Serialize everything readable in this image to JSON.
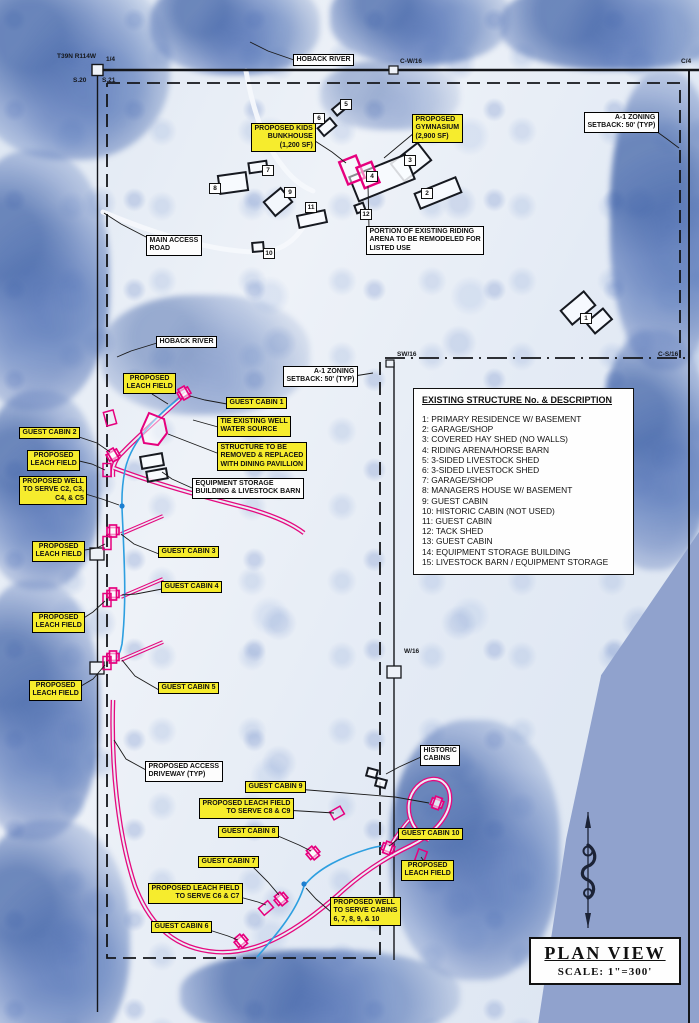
{
  "title_box": {
    "title": "PLAN VIEW",
    "scale": "SCALE:  1\"=300'"
  },
  "legend": {
    "title": "EXISTING STRUCTURE No. & DESCRIPTION",
    "items": [
      "1: PRIMARY RESIDENCE W/ BASEMENT",
      "2: GARAGE/SHOP",
      "3: COVERED HAY SHED (NO WALLS)",
      "4: RIDING ARENA/HORSE BARN",
      "5: 3-SIDED LIVESTOCK SHED",
      "6: 3-SIDED LIVESTOCK SHED",
      "7: GARAGE/SHOP",
      "8: MANAGERS HOUSE W/ BASEMENT",
      "9: GUEST CABIN",
      "10: HISTORIC CABIN (NOT USED)",
      "11: GUEST CABIN",
      "12: TACK SHED",
      "13: GUEST CABIN",
      "14: EQUIPMENT STORAGE BUILDING",
      "15: LIVESTOCK BARN / EQUIPMENT STORAGE"
    ]
  },
  "corner_texts": [
    {
      "text": "T39N  R114W",
      "x": 57,
      "y": 53
    },
    {
      "text": "1/4",
      "x": 106,
      "y": 56
    },
    {
      "text": "S.20",
      "x": 73,
      "y": 77
    },
    {
      "text": "S.21",
      "x": 102,
      "y": 77
    },
    {
      "text": "C-W/16",
      "x": 400,
      "y": 58
    },
    {
      "text": "C/4",
      "x": 681,
      "y": 58
    },
    {
      "text": "SW/16",
      "x": 397,
      "y": 351
    },
    {
      "text": "C-S/16",
      "x": 658,
      "y": 351
    },
    {
      "text": "W/16",
      "x": 404,
      "y": 648
    }
  ],
  "labels": [
    {
      "id": "label-hoback-river-top",
      "text": "HOBACK RIVER",
      "style": "white",
      "x": 293,
      "y": 54
    },
    {
      "id": "label-proposed-kids-bunkhouse",
      "text": "PROPOSED KIDS\nBUNKHOUSE\n(1,200 SF)",
      "style": "yellow",
      "x": 251,
      "y": 123,
      "align": "right"
    },
    {
      "id": "label-proposed-gymnasium",
      "text": "PROPOSED\nGYMNASIUM\n(2,900 SF)",
      "style": "yellow",
      "x": 412,
      "y": 114,
      "align": "left"
    },
    {
      "id": "label-a1-zoning-top",
      "text": "A-1 ZONING\nSETBACK: 50' (TYP)",
      "style": "white",
      "x": 584,
      "y": 112,
      "align": "right"
    },
    {
      "id": "label-main-access-road",
      "text": "MAIN ACCESS\nROAD",
      "style": "white",
      "x": 146,
      "y": 235,
      "align": "left"
    },
    {
      "id": "label-riding-arena-note",
      "text": "PORTION OF EXISTING RIDING\nARENA TO BE REMODELED FOR\nLISTED USE",
      "style": "white",
      "x": 366,
      "y": 226,
      "align": "left"
    },
    {
      "id": "label-hoback-river-mid",
      "text": "HOBACK RIVER",
      "style": "white",
      "x": 156,
      "y": 336
    },
    {
      "id": "label-a1-zoning-mid",
      "text": "A-1 ZONING\nSETBACK: 50' (TYP)",
      "style": "white",
      "x": 283,
      "y": 366,
      "align": "right"
    },
    {
      "id": "label-proposed-leach-field-1",
      "text": "PROPOSED\nLEACH FIELD",
      "style": "yellow",
      "x": 123,
      "y": 373
    },
    {
      "id": "label-guest-cabin-1",
      "text": "GUEST CABIN 1",
      "style": "yellow",
      "x": 226,
      "y": 397
    },
    {
      "id": "label-tie-existing-well",
      "text": "TIE EXISTING WELL\nWATER SOURCE",
      "style": "yellow",
      "x": 217,
      "y": 416,
      "align": "left"
    },
    {
      "id": "label-guest-cabin-2",
      "text": "GUEST CABIN 2",
      "style": "yellow",
      "x": 19,
      "y": 427
    },
    {
      "id": "label-structure-to-be-removed",
      "text": "STRUCTURE TO BE\nREMOVED & REPLACED\nWITH DINING PAVILLION",
      "style": "yellow",
      "x": 217,
      "y": 442,
      "align": "left"
    },
    {
      "id": "label-proposed-leach-field-2",
      "text": "PROPOSED\nLEACH FIELD",
      "style": "yellow",
      "x": 27,
      "y": 450
    },
    {
      "id": "label-proposed-well-c2-c5",
      "text": "PROPOSED WELL\nTO SERVE C2, C3,\nC4, & C5",
      "style": "yellow",
      "x": 19,
      "y": 476,
      "align": "right"
    },
    {
      "id": "label-equipment-storage",
      "text": "EQUIPMENT STORAGE\nBUILDING & LIVESTOCK BARN",
      "style": "white",
      "x": 192,
      "y": 478,
      "align": "left"
    },
    {
      "id": "label-proposed-leach-field-3",
      "text": "PROPOSED\nLEACH FIELD",
      "style": "yellow",
      "x": 32,
      "y": 541
    },
    {
      "id": "label-guest-cabin-3",
      "text": "GUEST CABIN 3",
      "style": "yellow",
      "x": 158,
      "y": 546
    },
    {
      "id": "label-guest-cabin-4",
      "text": "GUEST CABIN 4",
      "style": "yellow",
      "x": 161,
      "y": 581
    },
    {
      "id": "label-proposed-leach-field-4",
      "text": "PROPOSED\nLEACH FIELD",
      "style": "yellow",
      "x": 32,
      "y": 612
    },
    {
      "id": "label-proposed-leach-field-5",
      "text": "PROPOSED\nLEACH FIELD",
      "style": "yellow",
      "x": 29,
      "y": 680
    },
    {
      "id": "label-guest-cabin-5",
      "text": "GUEST CABIN 5",
      "style": "yellow",
      "x": 158,
      "y": 682
    },
    {
      "id": "label-proposed-access-driveway",
      "text": "PROPOSED ACCESS\nDRIVEWAY (TYP)",
      "style": "white",
      "x": 145,
      "y": 761,
      "align": "left"
    },
    {
      "id": "label-historic-cabins",
      "text": "HISTORIC\nCABINS",
      "style": "white",
      "x": 420,
      "y": 745,
      "align": "left"
    },
    {
      "id": "label-guest-cabin-9",
      "text": "GUEST CABIN 9",
      "style": "yellow",
      "x": 245,
      "y": 781
    },
    {
      "id": "label-leach-c8-c9",
      "text": "PROPOSED LEACH FIELD\nTO SERVE C8 & C9",
      "style": "yellow",
      "x": 199,
      "y": 798,
      "align": "right"
    },
    {
      "id": "label-guest-cabin-8",
      "text": "GUEST CABIN 8",
      "style": "yellow",
      "x": 218,
      "y": 826
    },
    {
      "id": "label-guest-cabin-10",
      "text": "GUEST CABIN 10",
      "style": "yellow",
      "x": 398,
      "y": 828
    },
    {
      "id": "label-proposed-leach-field-10",
      "text": "PROPOSED\nLEACH FIELD",
      "style": "yellow",
      "x": 401,
      "y": 860
    },
    {
      "id": "label-guest-cabin-7",
      "text": "GUEST CABIN 7",
      "style": "yellow",
      "x": 198,
      "y": 856
    },
    {
      "id": "label-leach-c6-c7",
      "text": "PROPOSED LEACH FIELD\nTO SERVE C6 & C7",
      "style": "yellow",
      "x": 148,
      "y": 883,
      "align": "right"
    },
    {
      "id": "label-proposed-well-6-10",
      "text": "PROPOSED WELL\nTO SERVE CABINS\n6, 7, 8, 9, & 10",
      "style": "yellow",
      "x": 330,
      "y": 897,
      "align": "left"
    },
    {
      "id": "label-guest-cabin-6",
      "text": "GUEST CABIN 6",
      "style": "yellow",
      "x": 151,
      "y": 921
    }
  ],
  "structure_markers": [
    {
      "n": "1",
      "x": 580,
      "y": 313
    },
    {
      "n": "2",
      "x": 421,
      "y": 188
    },
    {
      "n": "3",
      "x": 404,
      "y": 155
    },
    {
      "n": "4",
      "x": 366,
      "y": 171
    },
    {
      "n": "5",
      "x": 340,
      "y": 99
    },
    {
      "n": "6",
      "x": 313,
      "y": 113
    },
    {
      "n": "7",
      "x": 262,
      "y": 165
    },
    {
      "n": "8",
      "x": 209,
      "y": 183
    },
    {
      "n": "9",
      "x": 284,
      "y": 187
    },
    {
      "n": "10",
      "x": 263,
      "y": 248
    },
    {
      "n": "11",
      "x": 305,
      "y": 202
    },
    {
      "n": "12",
      "x": 360,
      "y": 209
    }
  ],
  "colors": {
    "label_highlight": "#f6ec2d",
    "driveway_pink": "#e5097f",
    "proposed_pink": "#e6007e",
    "water_blue": "#2d9fe0",
    "photo_edge_blue": "#90a2cd"
  }
}
